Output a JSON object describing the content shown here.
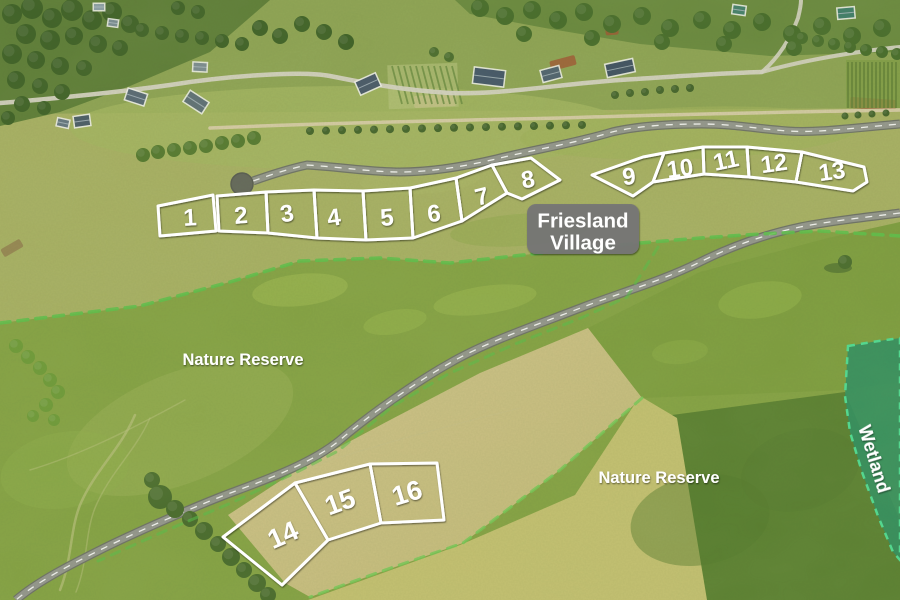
{
  "image_type": "aerial-development-plot-map",
  "village_label": {
    "line1": "Friesland",
    "line2": "Village"
  },
  "area_labels": {
    "nature_reserve_left": "Nature Reserve",
    "nature_reserve_right": "Nature Reserve",
    "wetland": "Wetland"
  },
  "plots": {
    "outline_color": "#ffffff",
    "outline_width": 3,
    "number_color": "#ffffff",
    "rows": [
      {
        "name": "upper-row-west",
        "font_size": 24,
        "plots": [
          {
            "n": "1",
            "polygon": "158,206 213,195 216,231 160,236",
            "x": 190,
            "y": 218,
            "rot": -3
          },
          {
            "n": "2",
            "polygon": "217,196 266,192 268,233 219,231",
            "x": 241,
            "y": 216,
            "rot": -5
          },
          {
            "n": "3",
            "polygon": "266,192 314,190 317,238 268,233",
            "x": 287,
            "y": 214,
            "rot": -10
          },
          {
            "n": "4",
            "polygon": "314,190 363,191 366,240 317,238",
            "x": 334,
            "y": 218,
            "rot": -8
          },
          {
            "n": "5",
            "polygon": "363,191 410,188 413,238 366,240",
            "x": 387,
            "y": 218,
            "rot": -5
          },
          {
            "n": "6",
            "polygon": "410,188 456,178 462,221 413,238",
            "x": 434,
            "y": 214,
            "rot": -6
          },
          {
            "n": "7",
            "polygon": "456,178 492,165 507,193 462,221",
            "x": 482,
            "y": 197,
            "rot": -14
          },
          {
            "n": "8",
            "polygon": "492,165 531,158 560,180 522,199 507,193",
            "x": 528,
            "y": 180,
            "rot": -10
          }
        ]
      },
      {
        "name": "upper-row-east",
        "font_size": 24,
        "plots": [
          {
            "n": "9",
            "polygon": "592,175 643,157 664,153 653,182 633,196",
            "x": 629,
            "y": 177,
            "rot": -6
          },
          {
            "n": "10",
            "polygon": "664,153 703,147 704,174 653,182",
            "x": 680,
            "y": 169,
            "rot": -8
          },
          {
            "n": "11",
            "polygon": "703,147 747,147 749,177 704,174",
            "x": 726,
            "y": 161,
            "rot": -12
          },
          {
            "n": "12",
            "polygon": "747,147 802,152 796,182 749,177",
            "x": 774,
            "y": 164,
            "rot": -8
          },
          {
            "n": "13",
            "polygon": "802,152 864,167 867,182 853,191 796,182",
            "x": 832,
            "y": 172,
            "rot": -8
          }
        ]
      },
      {
        "name": "lower-row",
        "font_size": 27,
        "plots": [
          {
            "n": "14",
            "polygon": "223,537 295,483 328,540 282,585",
            "x": 283,
            "y": 535,
            "rot": -24
          },
          {
            "n": "15",
            "polygon": "295,483 370,464 381,523 328,540",
            "x": 340,
            "y": 502,
            "rot": -20
          },
          {
            "n": "16",
            "polygon": "370,464 437,463 444,520 381,523",
            "x": 407,
            "y": 493,
            "rot": -17
          }
        ]
      }
    ]
  },
  "boundaries": [
    {
      "name": "nature-reserve-boundary-north",
      "points": "0,323 140,306 230,282 300,261 380,258 450,263 560,251 640,243 700,238 760,234 820,231 900,236",
      "color": "#5dc24c",
      "width": 3.5,
      "dash": "10 8",
      "opacity": 0.85
    },
    {
      "name": "nature-reserve-boundary-roadside",
      "points": "658,247 627,297 581,318 515,344 448,374 393,406 338,451 295,473 231,503 165,531 98,561",
      "color": "#58c14a",
      "width": 3,
      "dash": "9 8",
      "opacity": 0.55
    },
    {
      "name": "field-boundary-south",
      "points": "642,398 560,470 463,543 385,570 310,597",
      "color": "#74ca58",
      "width": 3,
      "dash": "9 8",
      "opacity": 0.8
    }
  ],
  "wetland": {
    "polygon": "848,346 872,342 900,338 900,560 893,552 878,516 862,472 850,432 845,396",
    "fill": "#2f8f63",
    "fill_opacity": 0.88,
    "dash_color": "#4fdd95"
  },
  "cul_de_sac": {
    "x": 242,
    "y": 184,
    "r": 11,
    "color": "#63665c"
  },
  "colors": {
    "road_surface": "#95978f",
    "road_edge": "#6f7268",
    "road_centerline": "#ffffff",
    "label_background": "#767676",
    "label_text": "#ffffff",
    "plot_outline": "#ffffff"
  }
}
